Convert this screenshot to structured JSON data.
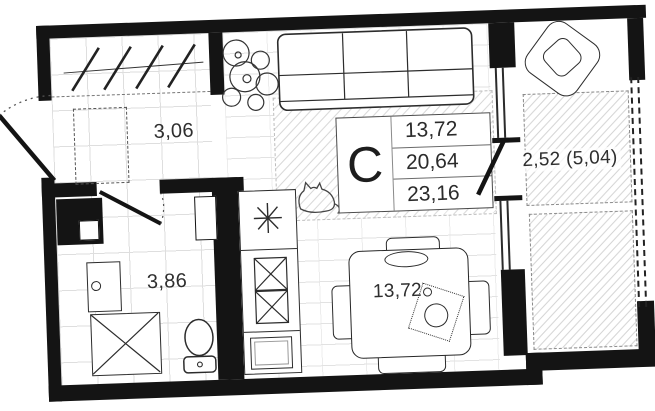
{
  "floor_plan": {
    "unit": {
      "type_label": "C",
      "area_rows": [
        "13,72",
        "20,64",
        "23,16"
      ]
    },
    "rooms": {
      "hallway": {
        "area": "3,06"
      },
      "bathroom": {
        "area": "3,86"
      },
      "living_dining": {
        "area": "13,72"
      },
      "balcony": {
        "area": "2,52 (5,04)"
      }
    },
    "colors": {
      "walls": "#141414",
      "line_work": "#2c2c2c",
      "text": "#2e2e2e",
      "floor_grid": "#dedede",
      "hatch": "#d6d6d6"
    },
    "icons": {
      "entry-door-icon": "arc-swing",
      "bathroom-door-icon": "arc-swing",
      "balcony-door-icon": "open-leaf",
      "closet-hangers-icon": "diagonal-slashes",
      "wardrobe-icon": "dashed-box",
      "washing-machine-icon": "box-with-porthole",
      "shower-icon": "box-with-cross",
      "toilet-icon": "bowl-and-tank",
      "sink-icon": "burst",
      "cabinet-x-icon": "x-squares",
      "appliance-icon": "nested-box",
      "sofa-icon": "cushioned-rect",
      "plant-icon": "leaf-circles",
      "cat-icon": "sketch-outline",
      "dining-table-icon": "rounded-square",
      "chair-icon": "rounded-rect",
      "armchair-icon": "rotated-square",
      "window-icon": "dashed-double-line"
    }
  }
}
